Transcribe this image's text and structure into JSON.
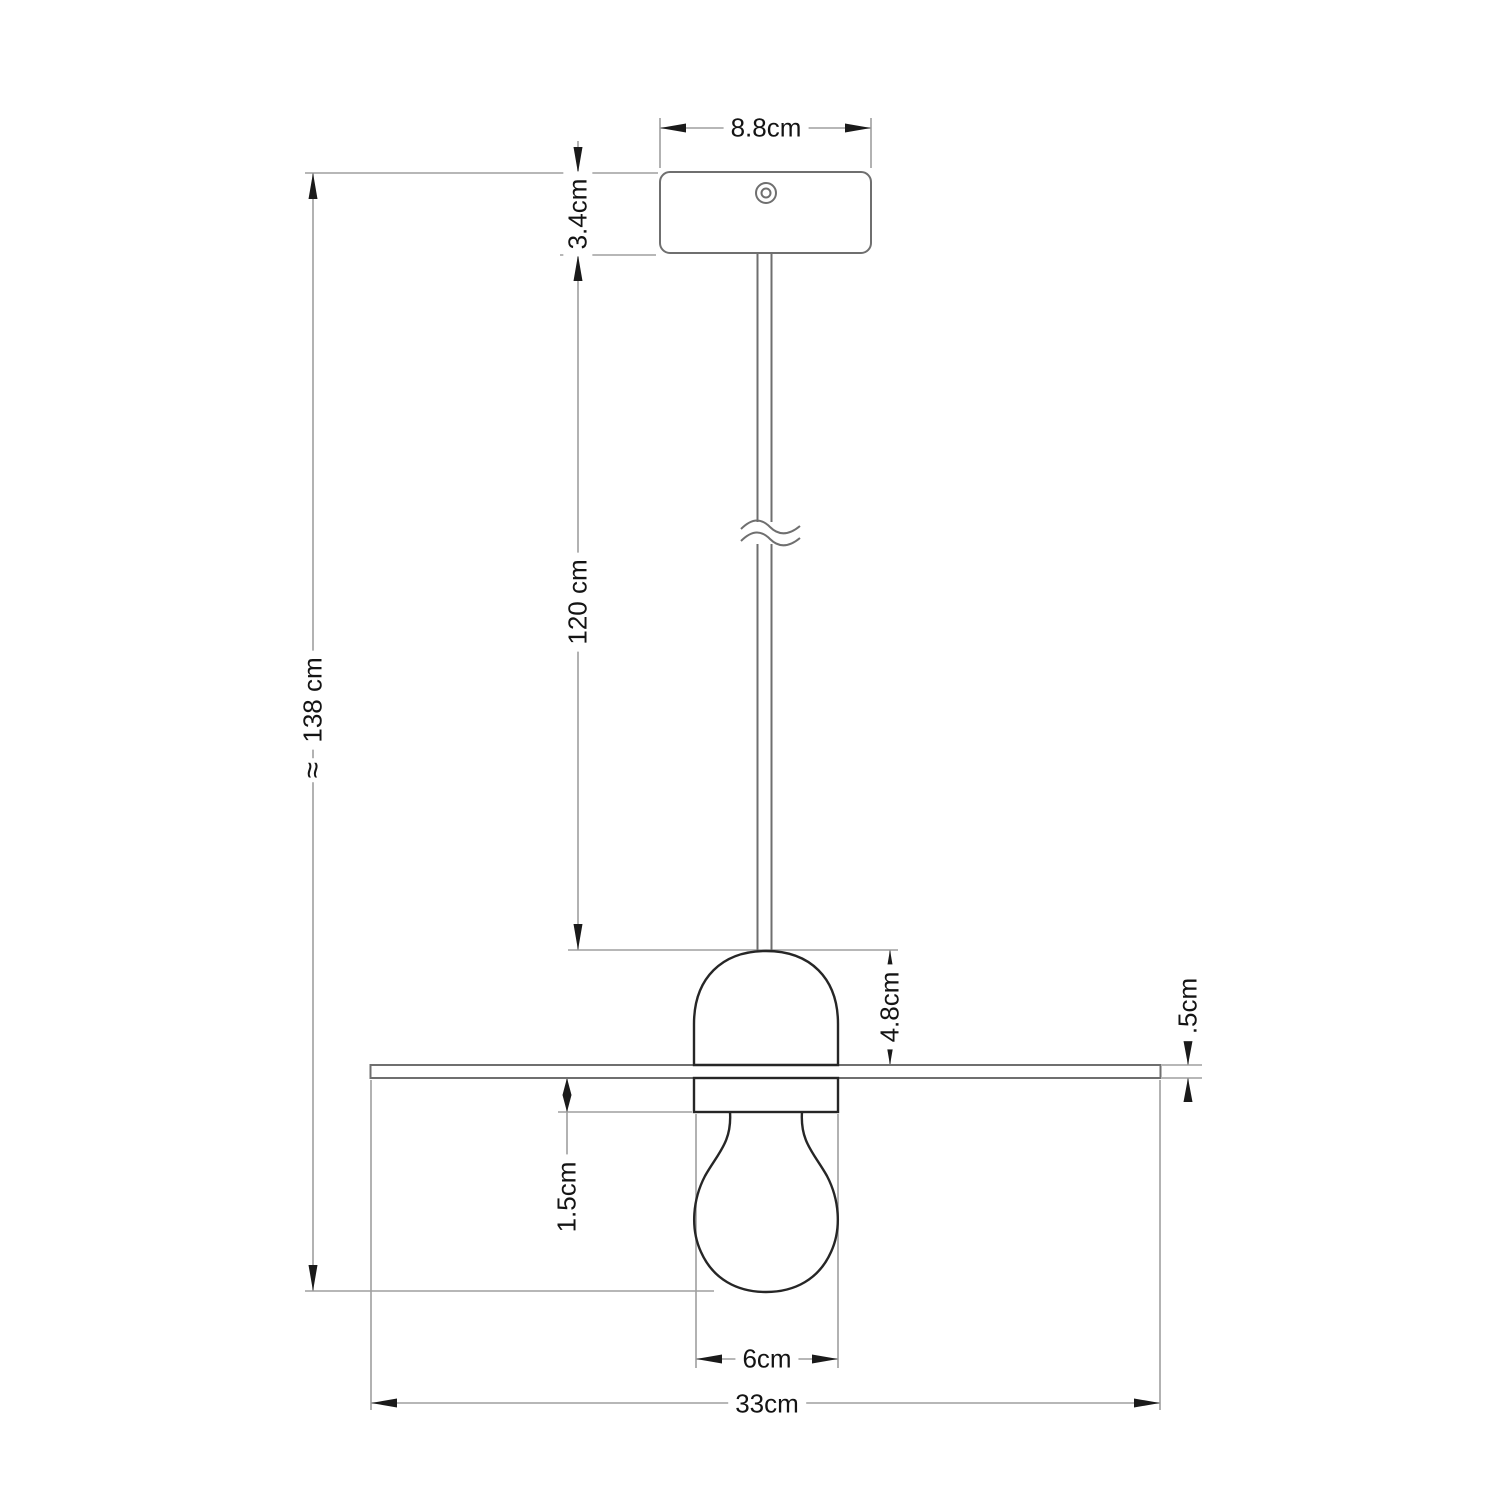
{
  "drawing": {
    "type": "technical-dimension-diagram",
    "subject": "pendant lamp with flat disc shade, ceiling canopy, cable and bulb",
    "units": "cm",
    "labels": {
      "canopy_width": "8.8cm",
      "canopy_height": "3.4cm",
      "cable_length": "120 cm",
      "total_height": "138 cm",
      "total_height_approx": "≈",
      "holder_height": "4.8cm",
      "disc_thickness": ".5cm",
      "socket_below_disc": "1.5cm",
      "bulb_diameter": "6cm",
      "disc_diameter": "33cm"
    },
    "colors": {
      "background": "#ffffff",
      "object_outline_dark": "#262626",
      "object_outline_gray": "#6f6f6f",
      "dimension_line": "#9f9f9f",
      "text_and_arrows": "#141414"
    }
  }
}
